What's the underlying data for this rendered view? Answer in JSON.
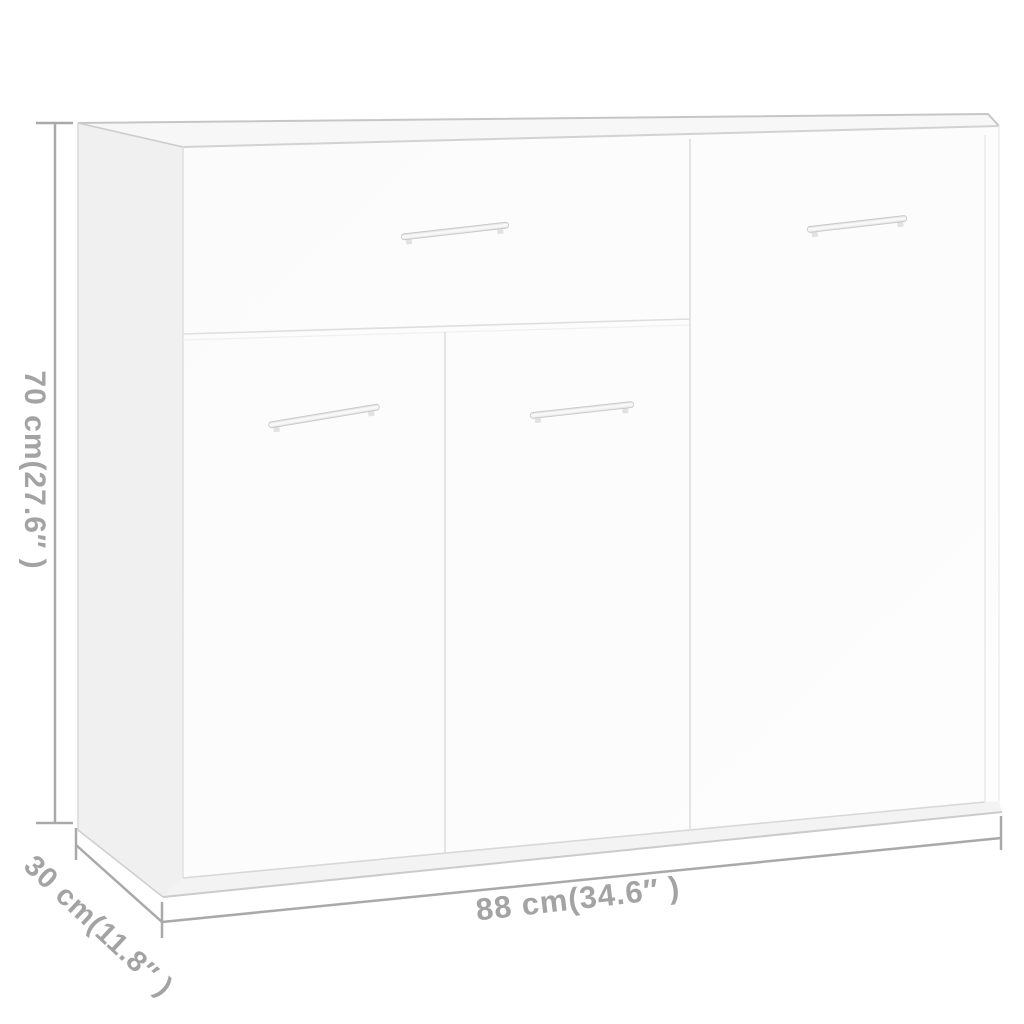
{
  "diagram": {
    "subject": "white sideboard with 1 drawer, 3 doors and 4 bar handles",
    "view": "front-left perspective product dimension diagram"
  },
  "dimensions": {
    "height_label": "70 cm(27.6″ )",
    "depth_label": "30 cm(11.8″ )",
    "width_label": "88 cm(34.6″ )"
  },
  "colors": {
    "background": "#ffffff",
    "annotation": "#a3a3a3",
    "cabinet_front": "#fcfcfc",
    "cabinet_side": "#f0f0f0",
    "cabinet_top": "#f7f7f7",
    "cabinet_plinth": "#f3f3f3",
    "panel_edge": "#dedede",
    "outline_edge": "#c6c6c6",
    "handle_fill": "#f2f2f2",
    "handle_stroke": "#c6c6c6"
  }
}
